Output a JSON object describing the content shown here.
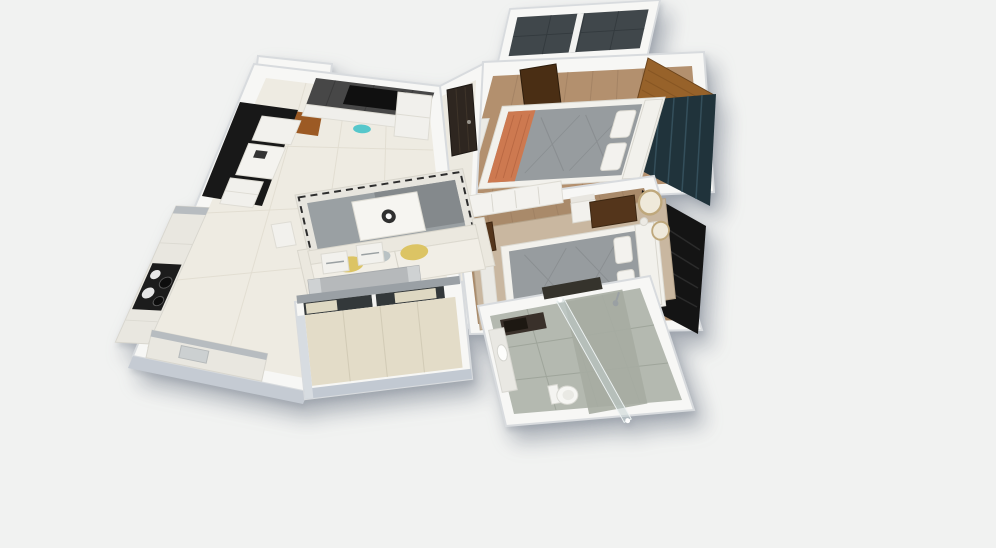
{
  "meta": {
    "description": "3D isometric rendering of a 2BHK apartment floor plan on a plain light background",
    "visible_text": "none"
  },
  "colors": {
    "background": "#f1f2f1",
    "wall_white": "#f7f7f5",
    "wall_stroke": "#d8dbde",
    "wall_face_south": "#c5cbd3",
    "wall_face_west": "#d7dce1",
    "hall_floor": "#eeebe2",
    "tile_line": "#ded9cc",
    "corridor_floor": "#ece9e0",
    "wood_floor_1": "#b3906e",
    "wood_floor_2": "#a98a6a",
    "plank_line": "#93755a",
    "slate_floor": "#40474b",
    "slate_line": "#333a3e",
    "balcony_floor": "#e3dcc8",
    "bath_floor": "#b4b9b0",
    "bath_tile_line": "#9fa59b",
    "shower_floor": "#a6aca2",
    "accent_black": "#181818",
    "tv_wall": "#474747",
    "tv_screen": "#101010",
    "entry_wood": "#9c5a24",
    "wardrobe_wood": "#97622a",
    "wardrobe_grain": "#7e4f1f",
    "door_walnut": "#54351b",
    "door_dark": "#4a2e14",
    "main_door": "#2e2620",
    "teal_wall": "#20333b",
    "teal_stripe": "#3a5663",
    "b2_wall": "#141414",
    "b2_weave": "#2b2b2b",
    "sofa_cream": "#ebe8df",
    "sofa_seat": "#f1eee6",
    "pillow_yellow": "#dcc464",
    "pillow_gray": "#b9c2c4",
    "rug_border": "#e7e5de",
    "rug_gray": "#9aa0a3",
    "rug_dark": "#84898c",
    "rug_stripe": "#2d2d2d",
    "rug_beige": "#c9b7a0",
    "bed_gray": "#979c9f",
    "bed_quilt": "#85898c",
    "bed_coral": "#cd7950",
    "bed_frame": "#f2f1ec",
    "table_gray": "#b6b9bb",
    "table_cap": "#cfd2d3",
    "chair_white": "#f2f1ed",
    "counter_white": "#e9e7e0",
    "counter_top": "#b7bcc0",
    "cooktop": "#1c1c1c",
    "burner_light": "#e6e6e6",
    "burner_dark": "#0d0d0d",
    "glass": "rgba(195,210,210,0.5)",
    "glazing_dark": "#33383a",
    "blind_cream": "#ded8c2",
    "sill_gray": "#9aa0a5",
    "mirror_gold": "#bfa87c",
    "mirror_face": "#efe9da",
    "vanity_dark": "#39302a",
    "toilet_white": "#f6f6f3",
    "teal_decor": "#45c3c9"
  },
  "scene": {
    "type": "3d-isometric-floor-plan",
    "unit": "2BHK apartment",
    "rooms": [
      {
        "id": "entry-foyer",
        "furniture": [
          "main-door",
          "shoe-cabinet",
          "tv-wall",
          "tv",
          "tv-console"
        ]
      },
      {
        "id": "living-room",
        "furniture": [
          "sofa",
          "yellow-pillows",
          "coffee-table",
          "area-rug",
          "study-desk",
          "black-accent-wall",
          "side-table"
        ]
      },
      {
        "id": "dining-area",
        "furniture": [
          "dining-table",
          "dining-chairs"
        ]
      },
      {
        "id": "kitchen",
        "furniture": [
          "west-counter",
          "cooktop",
          "south-counter",
          "sink"
        ]
      },
      {
        "id": "living-balcony",
        "furniture": [
          "sliding-windows",
          "blinds"
        ]
      },
      {
        "id": "bedroom-1",
        "furniture": [
          "double-bed",
          "coral-throw",
          "pillows",
          "wardrobe",
          "teal-accent-wall",
          "door",
          "bench"
        ]
      },
      {
        "id": "bedroom-1-balcony",
        "furniture": [
          "divider-wall"
        ]
      },
      {
        "id": "bedroom-2",
        "furniture": [
          "double-bed",
          "dresser-desk",
          "chair",
          "sideboard",
          "round-mirrors",
          "beige-rug",
          "black-accent-wall",
          "door",
          "bench"
        ]
      },
      {
        "id": "bathroom",
        "furniture": [
          "vanity-mirror",
          "wash-ledge",
          "basin",
          "toilet",
          "glass-shower-partition",
          "shower-head"
        ]
      },
      {
        "id": "corridor",
        "furniture": []
      }
    ]
  }
}
